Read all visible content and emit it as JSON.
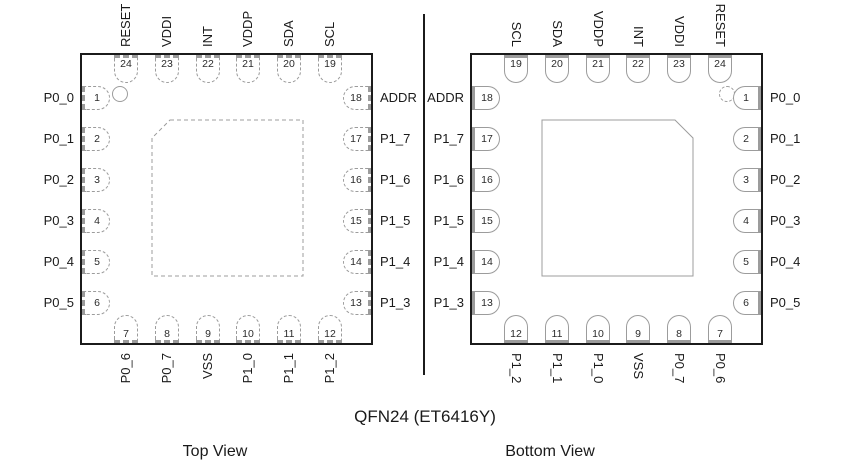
{
  "title": "QFN24 (ET6416Y)",
  "colors": {
    "chip_outline": "#1b1b1b",
    "pin_outline": "#9c9c9c",
    "text": "#1a1a1a"
  },
  "views": [
    {
      "id": "top-view",
      "caption": "Top View",
      "line_style": "dashed",
      "indicator_corner": "top-left",
      "chamfer_corner": "top-left",
      "label_direction": "up",
      "pins": {
        "top": [
          {
            "num": "24",
            "label": "RESET"
          },
          {
            "num": "23",
            "label": "VDDI"
          },
          {
            "num": "22",
            "label": "INT"
          },
          {
            "num": "21",
            "label": "VDDP"
          },
          {
            "num": "20",
            "label": "SDA"
          },
          {
            "num": "19",
            "label": "SCL"
          }
        ],
        "left": [
          {
            "num": "1",
            "label": "P0_0"
          },
          {
            "num": "2",
            "label": "P0_1"
          },
          {
            "num": "3",
            "label": "P0_2"
          },
          {
            "num": "4",
            "label": "P0_3"
          },
          {
            "num": "5",
            "label": "P0_4"
          },
          {
            "num": "6",
            "label": "P0_5"
          }
        ],
        "right": [
          {
            "num": "18",
            "label": "ADDR"
          },
          {
            "num": "17",
            "label": "P1_7"
          },
          {
            "num": "16",
            "label": "P1_6"
          },
          {
            "num": "15",
            "label": "P1_5"
          },
          {
            "num": "14",
            "label": "P1_4"
          },
          {
            "num": "13",
            "label": "P1_3"
          }
        ],
        "bottom": [
          {
            "num": "7",
            "label": "P0_6"
          },
          {
            "num": "8",
            "label": "P0_7"
          },
          {
            "num": "9",
            "label": "VSS"
          },
          {
            "num": "10",
            "label": "P1_0"
          },
          {
            "num": "11",
            "label": "P1_1"
          },
          {
            "num": "12",
            "label": "P1_2"
          }
        ]
      }
    },
    {
      "id": "bottom-view",
      "caption": "Bottom View",
      "line_style": "solid",
      "indicator_corner": "top-right",
      "chamfer_corner": "top-right",
      "label_direction": "down",
      "pins": {
        "top": [
          {
            "num": "19",
            "label": "SCL"
          },
          {
            "num": "20",
            "label": "SDA"
          },
          {
            "num": "21",
            "label": "VDDP"
          },
          {
            "num": "22",
            "label": "INT"
          },
          {
            "num": "23",
            "label": "VDDI"
          },
          {
            "num": "24",
            "label": "RESET"
          }
        ],
        "left": [
          {
            "num": "18",
            "label": "ADDR"
          },
          {
            "num": "17",
            "label": "P1_7"
          },
          {
            "num": "16",
            "label": "P1_6"
          },
          {
            "num": "15",
            "label": "P1_5"
          },
          {
            "num": "14",
            "label": "P1_4"
          },
          {
            "num": "13",
            "label": "P1_3"
          }
        ],
        "right": [
          {
            "num": "1",
            "label": "P0_0"
          },
          {
            "num": "2",
            "label": "P0_1"
          },
          {
            "num": "3",
            "label": "P0_2"
          },
          {
            "num": "4",
            "label": "P0_3"
          },
          {
            "num": "5",
            "label": "P0_4"
          },
          {
            "num": "6",
            "label": "P0_5"
          }
        ],
        "bottom": [
          {
            "num": "12",
            "label": "P1_2"
          },
          {
            "num": "11",
            "label": "P1_1"
          },
          {
            "num": "10",
            "label": "P1_0"
          },
          {
            "num": "9",
            "label": "VSS"
          },
          {
            "num": "8",
            "label": "P0_7"
          },
          {
            "num": "7",
            "label": "P0_6"
          }
        ]
      }
    }
  ]
}
